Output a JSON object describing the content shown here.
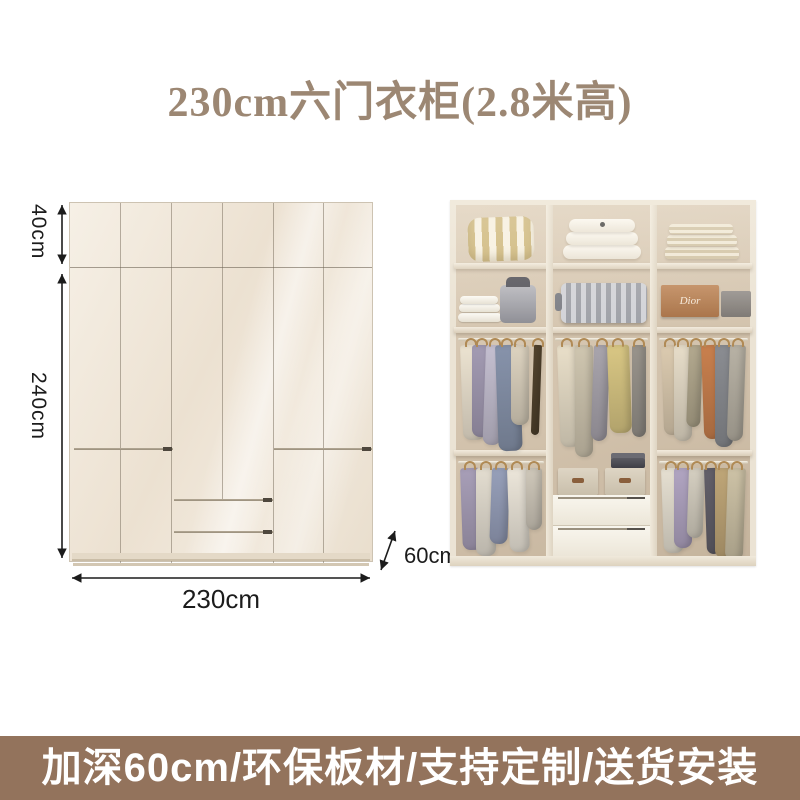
{
  "title": {
    "text": "230cm六门衣柜(2.8米高)"
  },
  "diagram": {
    "labels": {
      "top_section_height": "40cm",
      "body_height": "240cm",
      "width": "230cm",
      "depth": "60cm"
    }
  },
  "photo": {
    "dior_box_label": "Dior",
    "garments": {
      "row3_left": [
        {
          "c": "#ece3d1",
          "h": 95,
          "w": 22
        },
        {
          "c": "#a39bb3",
          "h": 92,
          "w": 20
        },
        {
          "c": "#c4bfd0",
          "h": 100,
          "w": 18
        },
        {
          "c": "#8793ab",
          "h": 106,
          "w": 24
        },
        {
          "c": "#ddd3c0",
          "h": 80,
          "w": 18
        },
        {
          "c": "#54452f",
          "h": 90,
          "w": 8
        }
      ],
      "row3_middle": [
        {
          "c": "#e9dfc9",
          "h": 102,
          "w": 20
        },
        {
          "c": "#cfc6b0",
          "h": 112,
          "w": 18
        },
        {
          "c": "#a9a5ad",
          "h": 96,
          "w": 16
        },
        {
          "c": "#d9c784",
          "h": 88,
          "w": 22
        },
        {
          "c": "#99948c",
          "h": 92,
          "w": 14
        }
      ],
      "row3_right": [
        {
          "c": "#dccbb0",
          "h": 90,
          "w": 18
        },
        {
          "c": "#e7ddc9",
          "h": 96,
          "w": 18
        },
        {
          "c": "#b3a98f",
          "h": 82,
          "w": 14
        },
        {
          "c": "#c9804e",
          "h": 94,
          "w": 18
        },
        {
          "c": "#8b8d92",
          "h": 102,
          "w": 18
        },
        {
          "c": "#b8b2a5",
          "h": 96,
          "w": 16
        }
      ],
      "row4_left": [
        {
          "c": "#a89fb8",
          "h": 82,
          "w": 20
        },
        {
          "c": "#e3ddd0",
          "h": 88,
          "w": 20
        },
        {
          "c": "#97a0ba",
          "h": 76,
          "w": 18
        },
        {
          "c": "#ece6da",
          "h": 84,
          "w": 20
        },
        {
          "c": "#cfc8ba",
          "h": 62,
          "w": 16
        }
      ],
      "row4_right": [
        {
          "c": "#e6e0d2",
          "h": 85,
          "w": 20
        },
        {
          "c": "#b1a5c2",
          "h": 80,
          "w": 18
        },
        {
          "c": "#d5cfc1",
          "h": 70,
          "w": 16
        },
        {
          "c": "#63606a",
          "h": 86,
          "w": 14
        },
        {
          "c": "#bfa678",
          "h": 90,
          "w": 18
        },
        {
          "c": "#cdc2a6",
          "h": 92,
          "w": 18
        }
      ]
    }
  },
  "banner": {
    "text": "加深60cm/环保板材/支持定制/送货安装"
  },
  "palette": {
    "page_background": "#ffffff",
    "title_color": "#9c8773",
    "banner_background": "#93735c",
    "banner_text_color": "#ffffff",
    "wardrobe_cream": "#f2ebdf",
    "dimension_text_color": "#1c1c1c"
  }
}
